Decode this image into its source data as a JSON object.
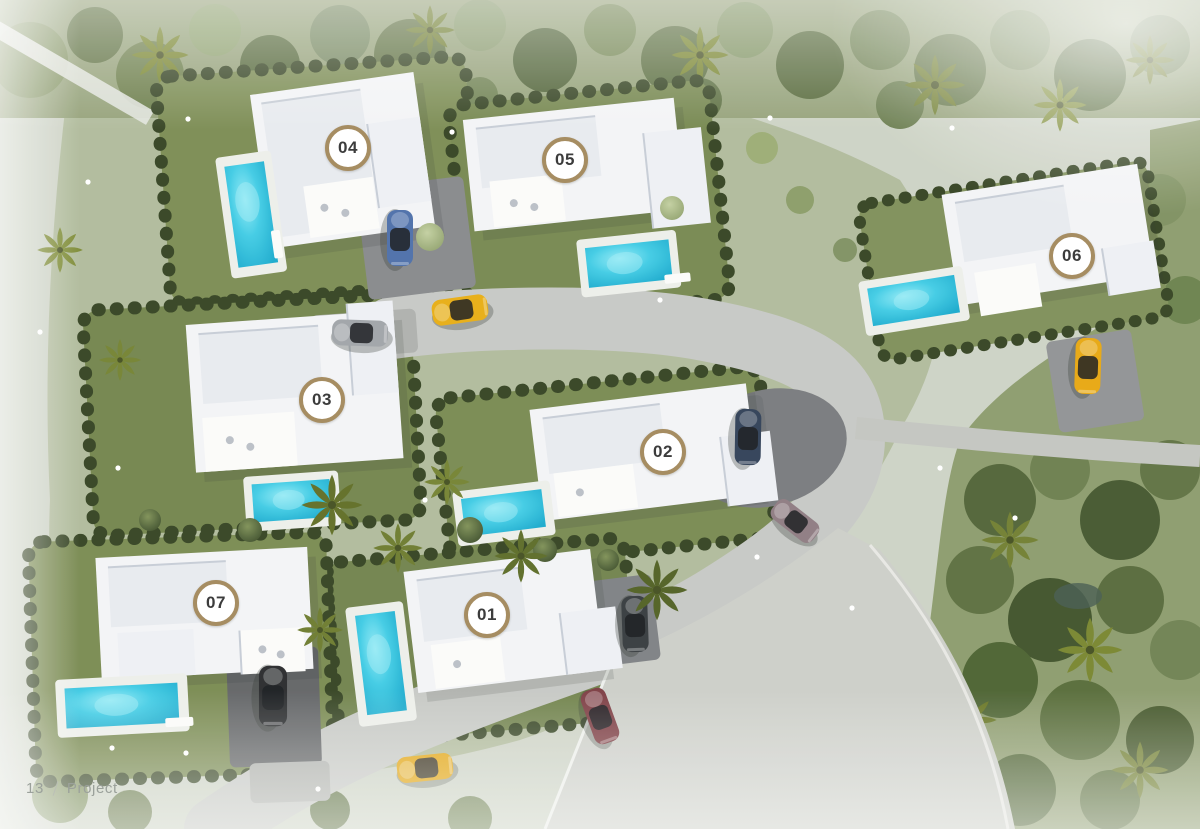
{
  "title": "Aerial masterplan render of a seven-villa residential development",
  "villas": [
    {
      "number": "04",
      "cx": 348,
      "cy": 148
    },
    {
      "number": "05",
      "cx": 565,
      "cy": 160
    },
    {
      "number": "06",
      "cx": 1072,
      "cy": 256
    },
    {
      "number": "03",
      "cx": 322,
      "cy": 400
    },
    {
      "number": "02",
      "cx": 663,
      "cy": 452
    },
    {
      "number": "01",
      "cx": 487,
      "cy": 615
    },
    {
      "number": "07",
      "cx": 216,
      "cy": 603
    }
  ],
  "footer": {
    "page_number": "13",
    "section_label": "Project"
  },
  "vehicles": [
    {
      "name": "yellow-car-on-upper-road",
      "color": "#e7ac10"
    },
    {
      "name": "blue-car-villa-04-driveway",
      "color": "#4a6da8"
    },
    {
      "name": "gray-car-villa-03-apron",
      "color": "#9fa3a7"
    },
    {
      "name": "dark-blue-car-villa-02-driveway",
      "color": "#2e3e55"
    },
    {
      "name": "mauve-car-on-road",
      "color": "#8d7a80"
    },
    {
      "name": "yellow-car-villa-06-driveway",
      "color": "#e7a60d"
    },
    {
      "name": "black-suv-villa-07-driveway",
      "color": "#26282a"
    },
    {
      "name": "dark-car-villa-01-driveway",
      "color": "#33383b"
    },
    {
      "name": "red-car-on-south-road",
      "color": "#7b3a40"
    },
    {
      "name": "yellow-car-on-south-road",
      "color": "#e2a30b"
    }
  ],
  "colors": {
    "badge_ring": "#a68d62",
    "badge_background": "#ffffff",
    "badge_text": "#3c3c3c",
    "pool_water": "#2bbfdd",
    "lawn": "#76874f",
    "hedge": "#32411f",
    "road": "#c6c8c4",
    "building": "#f3f4f6",
    "footer_text": "#9ba19b"
  }
}
